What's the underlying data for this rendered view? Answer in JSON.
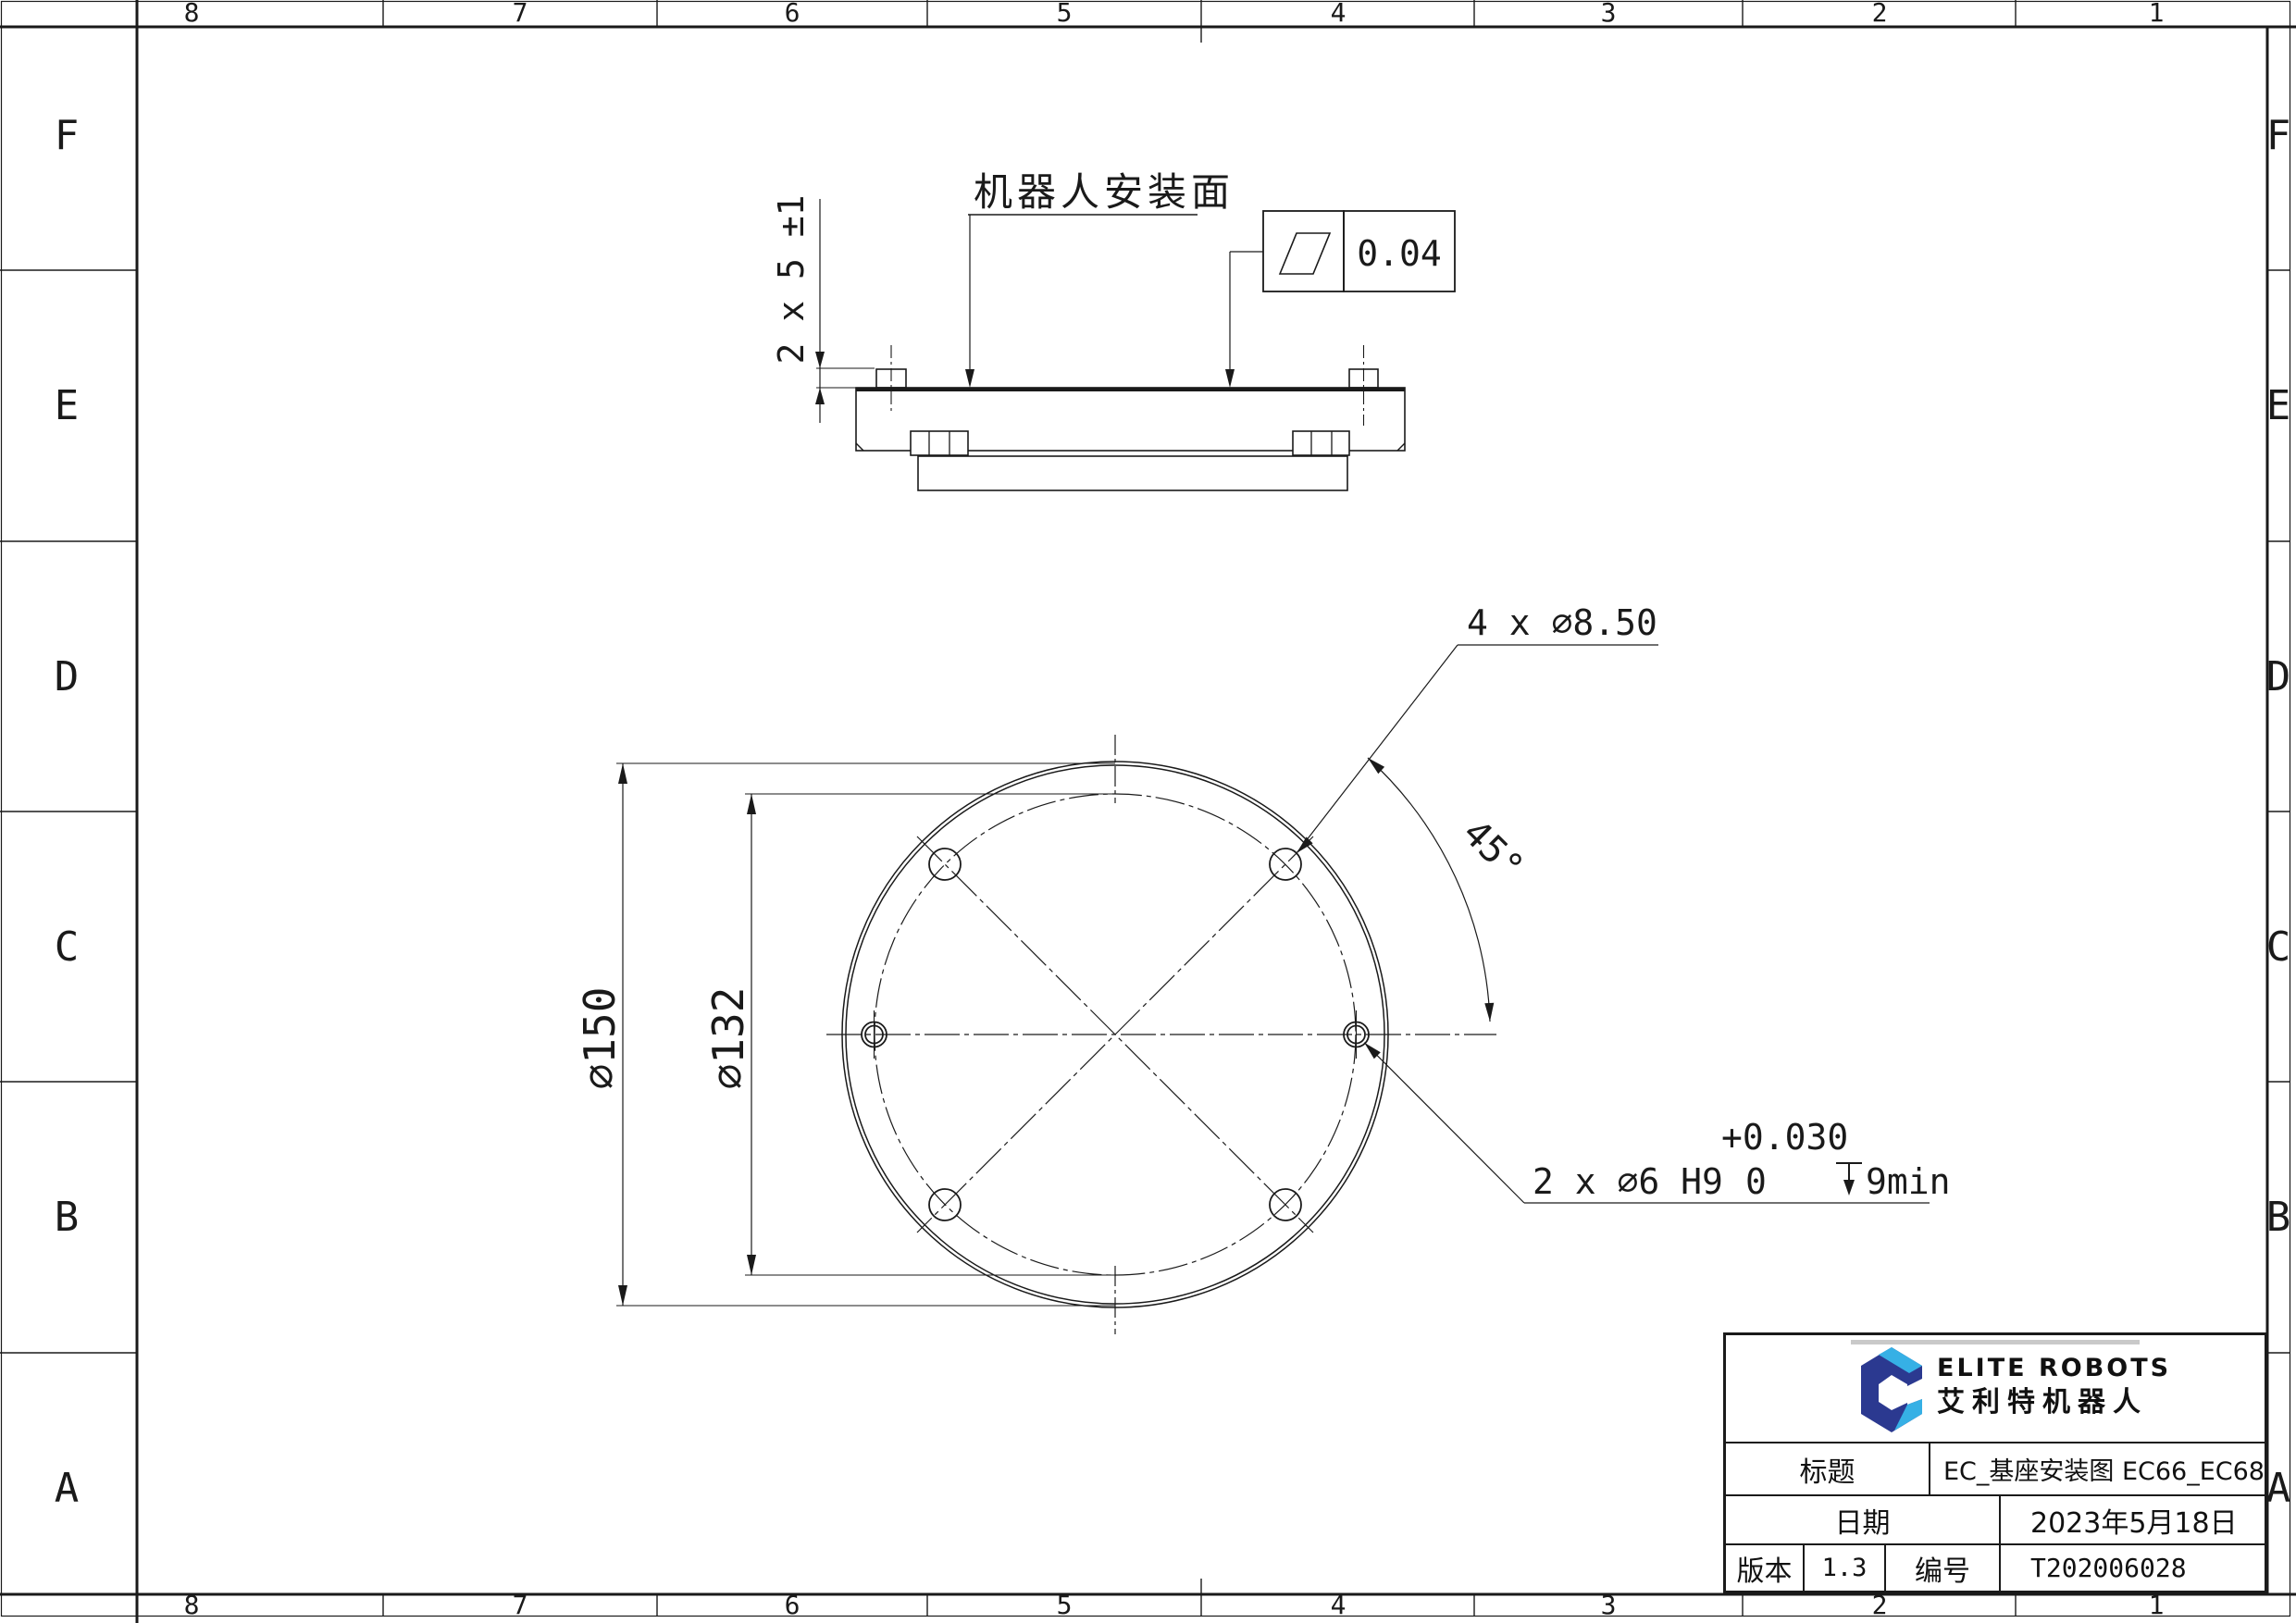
{
  "sheet": {
    "zones_cols": [
      "8",
      "7",
      "6",
      "5",
      "4",
      "3",
      "2",
      "1"
    ],
    "zones_rows": [
      "F",
      "E",
      "D",
      "C",
      "B",
      "A"
    ]
  },
  "drawing": {
    "mount_face_label": "机器人安装面",
    "pin_height_dim": "2 x 5 ±1",
    "flatness_value": "0.04",
    "bolt_holes_dim": "4 x ⌀8.50",
    "angle_dim": "45°",
    "outer_dia_dim": "⌀150",
    "bolt_circle_dia_dim": "⌀132",
    "pin_holes_dim": "2 x ⌀6 H9",
    "pin_holes_tol_nominal": "0",
    "pin_holes_tol_upper": "+0.030",
    "pin_holes_depth": "9min"
  },
  "title_block": {
    "brand_en": "ELITE ROBOTS",
    "brand_cn": "艾利特机器人",
    "title_label": "标题",
    "title_value": "EC_基座安装图 EC66_EC68",
    "date_label": "日期",
    "date_value": "2023年5月18日",
    "version_label": "版本",
    "version_value": "1.3",
    "number_label": "编号",
    "number_value": "T202006028"
  },
  "colors": {
    "line": "#1a1a1a",
    "brand_navy": "#2b3990",
    "brand_blue": "#36b0e5",
    "rule_grey": "#c9c9c9"
  }
}
